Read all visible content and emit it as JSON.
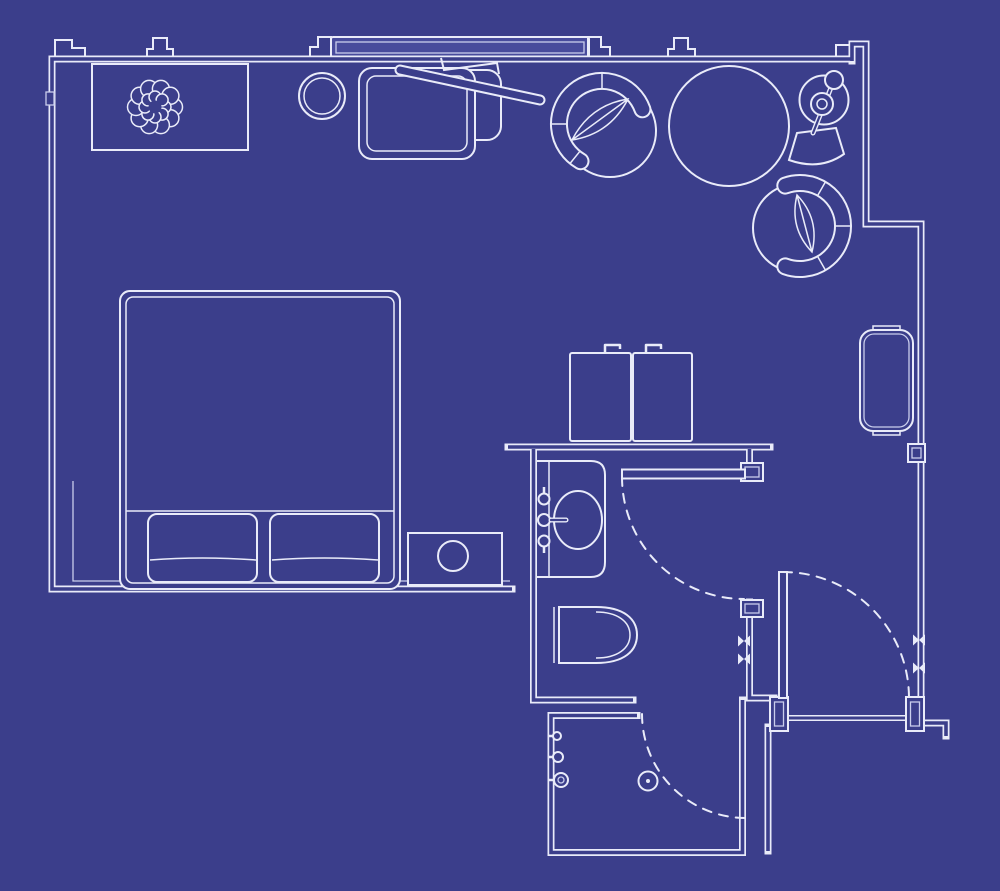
{
  "meta": {
    "title": "Hotel guest room floor plan",
    "style": "blueprint line drawing, white lines on indigo background",
    "canvas": {
      "width": 1000,
      "height": 891
    }
  },
  "colors": {
    "background": "#3b3e8b",
    "line": "#e9ebf9",
    "line-soft": "#c9cdec",
    "panel-fill": "#484b9c"
  },
  "rooms": [
    {
      "name": "bedroom",
      "position": "upper left, open plan"
    },
    {
      "name": "bathroom",
      "position": "center bottom, with vanity and toilet"
    },
    {
      "name": "shower-room",
      "position": "bottom center, with floor drain"
    },
    {
      "name": "entry-vestibule",
      "position": "bottom right, entry door"
    }
  ],
  "inventory": {
    "bedroom": [
      "window-wall",
      "window-panel",
      "console-table",
      "flower-decor",
      "stool",
      "lounge-chair",
      "ottoman",
      "wall-desk",
      "swivel-armchair-1",
      "round-table",
      "floor-lamp",
      "swivel-armchair-2",
      "bed",
      "pillow-left",
      "pillow-right",
      "nightstand",
      "table-lamp",
      "twin-basin-left",
      "twin-basin-right",
      "luggage-bench",
      "wall-panel-switch"
    ],
    "bathroom": [
      "vanity-counter",
      "oval-sink",
      "faucet",
      "faucet-knob-top",
      "faucet-knob-bottom",
      "toilet",
      "bathroom-door",
      "bathroom-door-swing"
    ],
    "shower_room": [
      "shower-knob-1",
      "shower-knob-2",
      "shower-head",
      "floor-drain",
      "shower-door-swing"
    ],
    "entry": [
      "entry-door-leaf",
      "entry-door-swing",
      "door-jambs",
      "threshold",
      "hinge-marks"
    ]
  }
}
